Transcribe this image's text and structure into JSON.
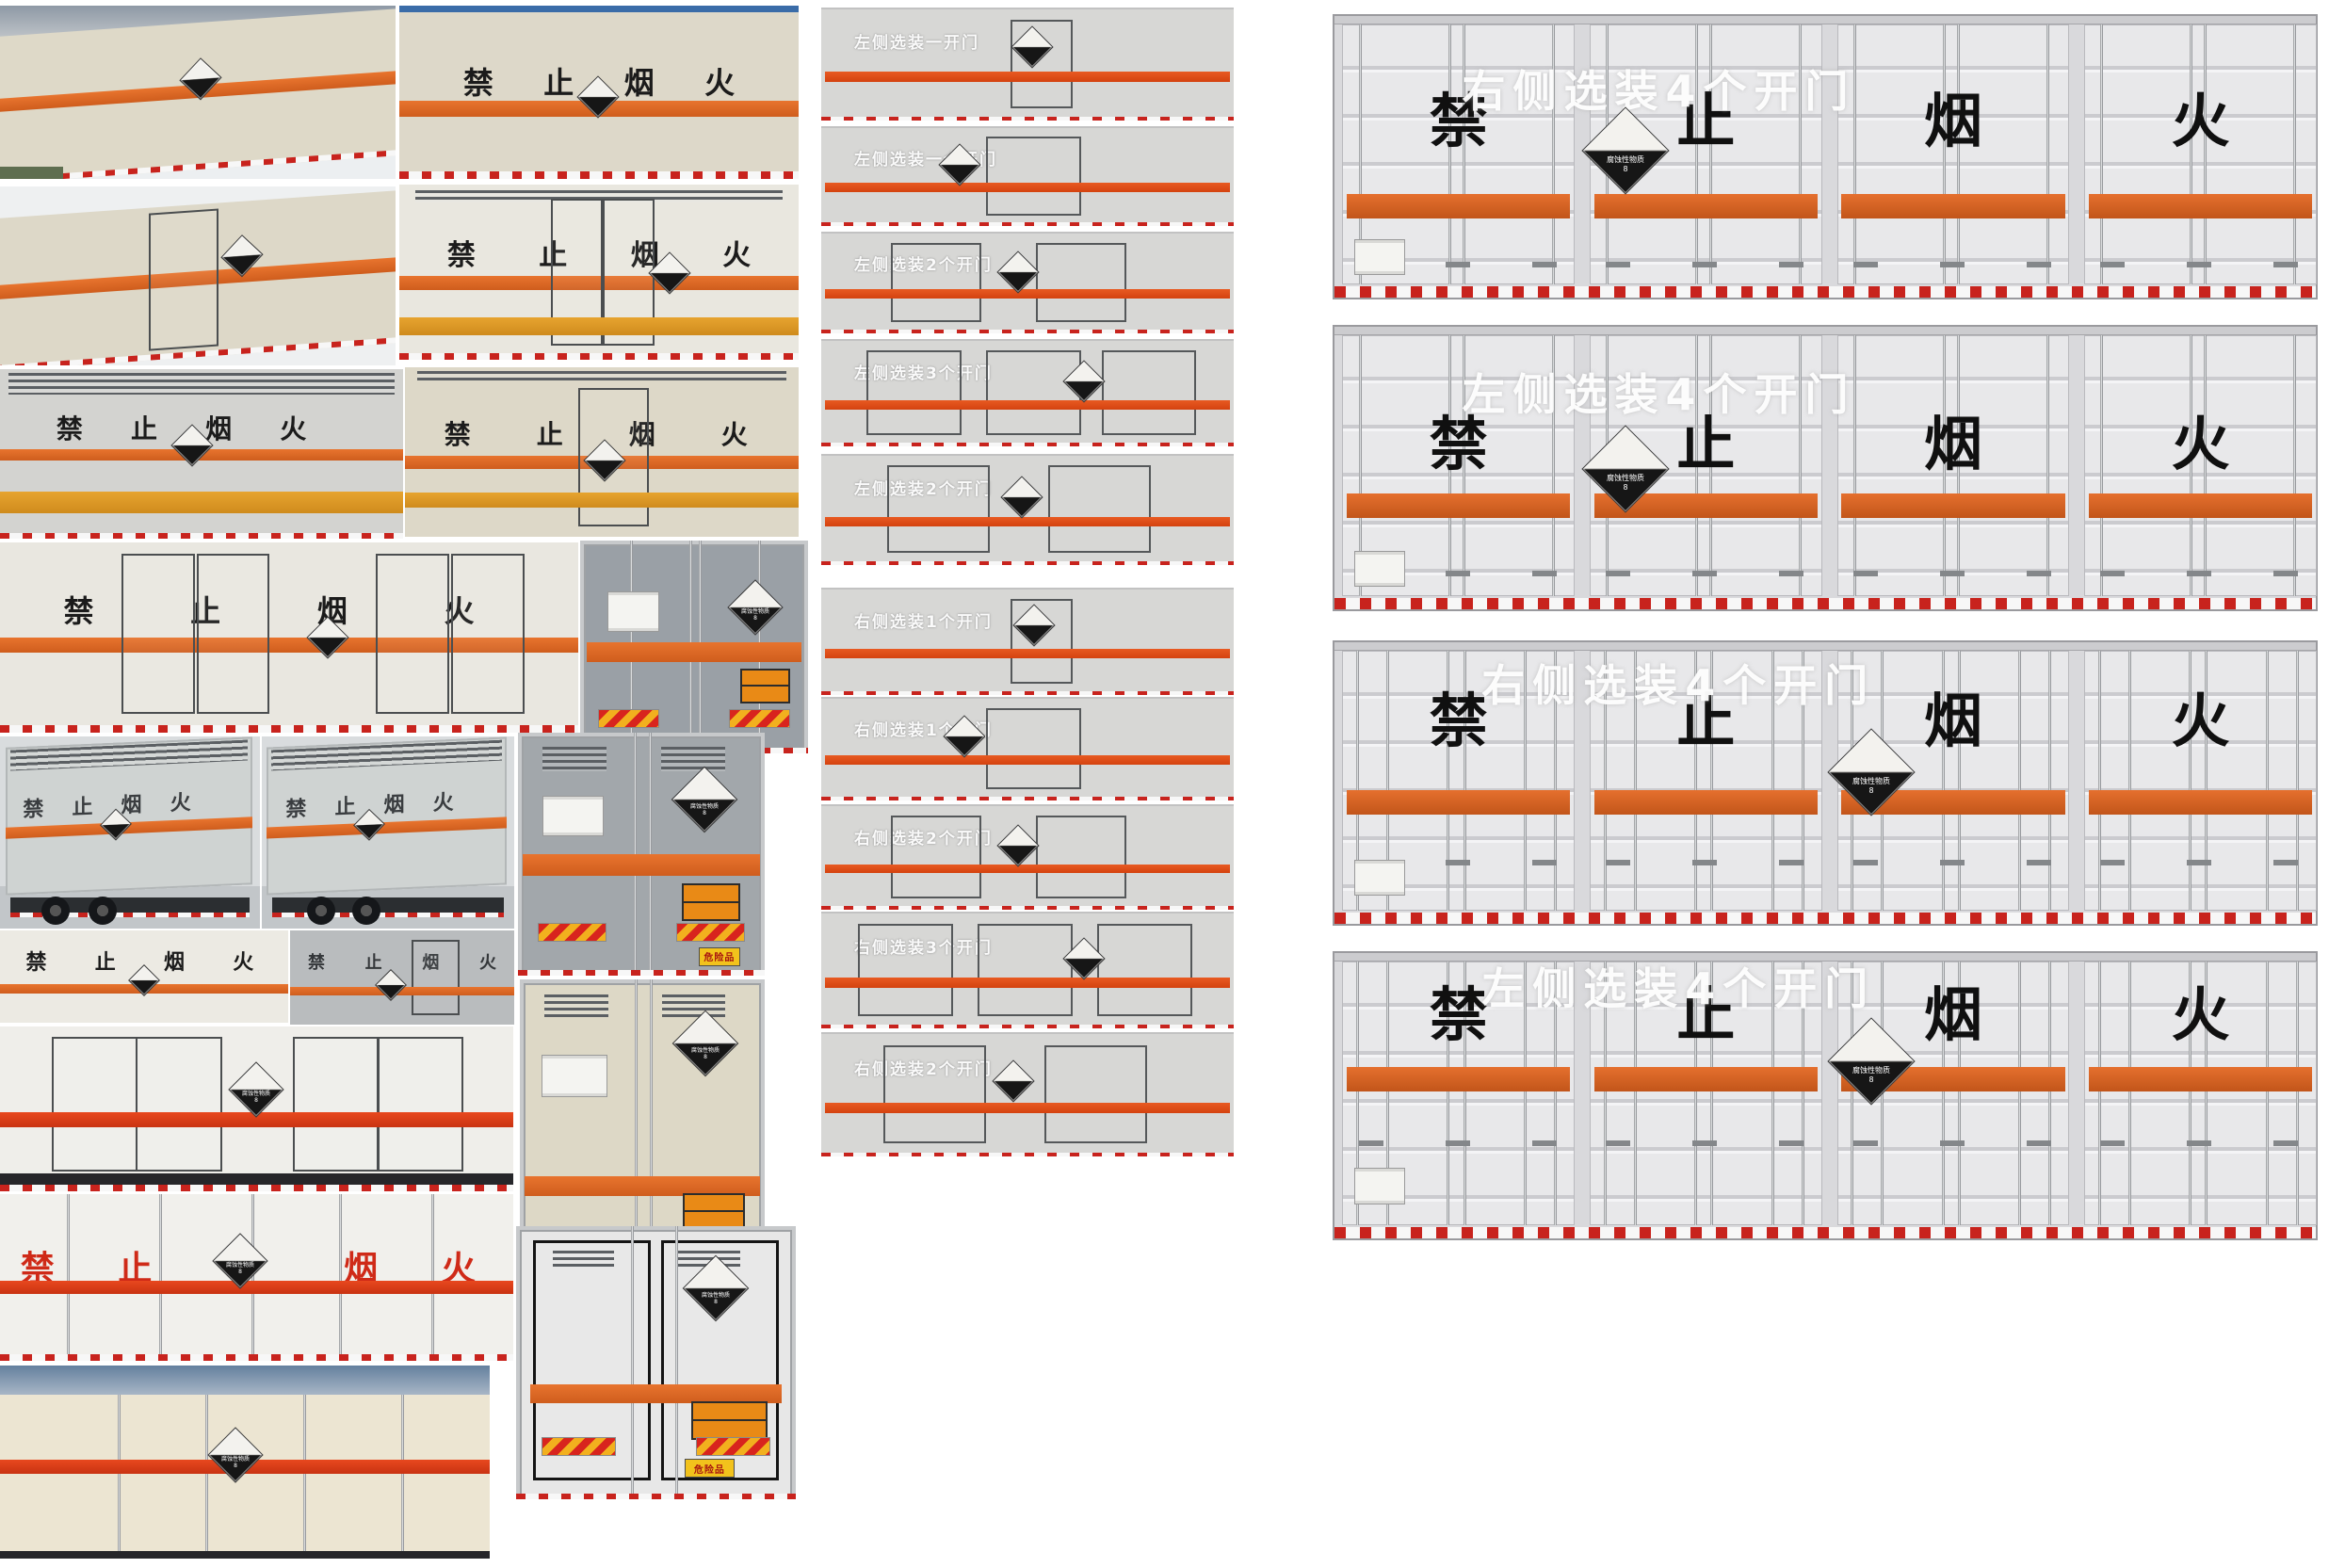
{
  "texts": {
    "warning": "禁止烟火",
    "warning_chars": [
      "禁",
      "止",
      "烟",
      "火"
    ],
    "corrosive_label": "腐蚀性物质",
    "corrosive_class": "8",
    "danger_plate": "危险品"
  },
  "middle_bands": [
    {
      "label": "左侧选装一开门"
    },
    {
      "label": "左侧选装一个开门"
    },
    {
      "label": "左侧选装2个开门"
    },
    {
      "label": "左侧选装3个开门"
    },
    {
      "label": "左侧选装2个开门"
    },
    {
      "label": "右侧选装1个开门"
    },
    {
      "label": "右侧选装1个开门"
    },
    {
      "label": "右侧选装2个开门"
    },
    {
      "label": "右侧选装3个开门"
    },
    {
      "label": "右侧选装2个开门"
    }
  ],
  "right_panels": [
    {
      "header": "右侧选装4个开门"
    },
    {
      "header": "左侧选装4个开门"
    },
    {
      "header": "右侧选装4个开门"
    },
    {
      "header": "左侧选装4个开门"
    }
  ],
  "colors": {
    "orange_stripe": "#e8742e",
    "red_orange_stripe": "#e8481e",
    "amber_band": "#e7a42f",
    "red_warning_text": "#cf2a18",
    "panel_body": "#d9d9dc",
    "van_cream": "#ded9c8",
    "van_gray": "#9aa0a6",
    "sky_blue": "#3a6ca8",
    "dash_red": "#c8231d",
    "placard_black": "#161616",
    "danger_yellow": "#f2c21c"
  }
}
